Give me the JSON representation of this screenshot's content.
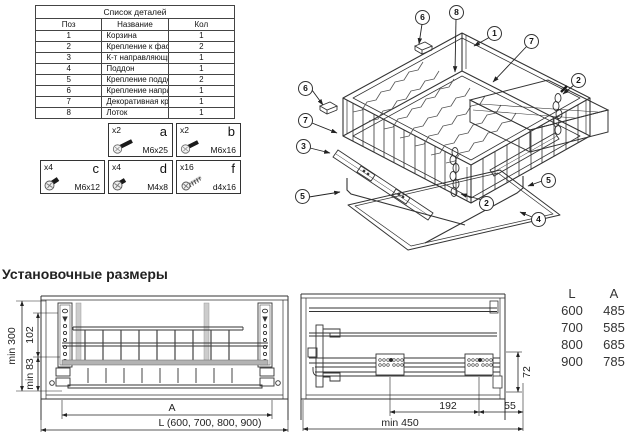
{
  "parts_table": {
    "title": "Список деталей",
    "headers": {
      "pos": "Поз",
      "name": "Название",
      "qty": "Кол"
    },
    "rows": [
      {
        "pos": "1",
        "name": "Корзина",
        "qty": "1"
      },
      {
        "pos": "2",
        "name": "Крепление к фасаду",
        "qty": "2"
      },
      {
        "pos": "3",
        "name": "К-т направляющих 450 мм",
        "qty": "1"
      },
      {
        "pos": "4",
        "name": "Поддон",
        "qty": "1"
      },
      {
        "pos": "5",
        "name": "Крепление поддона",
        "qty": "2"
      },
      {
        "pos": "6",
        "name": "Крепление направляющей",
        "qty": "1"
      },
      {
        "pos": "7",
        "name": "Декоративная крышка",
        "qty": "1"
      },
      {
        "pos": "8",
        "name": "Лоток",
        "qty": "1"
      }
    ]
  },
  "fasteners": [
    {
      "count": "x2",
      "letter": "a",
      "size": "M6x25"
    },
    {
      "count": "x2",
      "letter": "b",
      "size": "M6x16"
    },
    {
      "count": "x4",
      "letter": "c",
      "size": "M6x12"
    },
    {
      "count": "x4",
      "letter": "d",
      "size": "M4x8"
    },
    {
      "count": "x16",
      "letter": "f",
      "size": "d4x16"
    }
  ],
  "exploded_view": {
    "callouts": [
      "6",
      "8",
      "1",
      "7",
      "2",
      "6",
      "7",
      "3",
      "5",
      "2",
      "5",
      "4"
    ]
  },
  "install": {
    "heading": "Установочные размеры",
    "front_view_dims": {
      "height_min": "min 300",
      "upper_span": "102",
      "lower_span": "min 83",
      "width_a": "A",
      "width_l": "L (600, 700, 800, 900)"
    },
    "side_view_dims": {
      "block_spacing": "192",
      "front_offset": "55",
      "rail_height": "72",
      "depth_min": "min 450"
    },
    "size_table": {
      "col_l": "L",
      "col_a": "A",
      "rows": [
        {
          "l": "600",
          "a": "485"
        },
        {
          "l": "700",
          "a": "585"
        },
        {
          "l": "800",
          "a": "685"
        },
        {
          "l": "900",
          "a": "785"
        }
      ]
    }
  }
}
